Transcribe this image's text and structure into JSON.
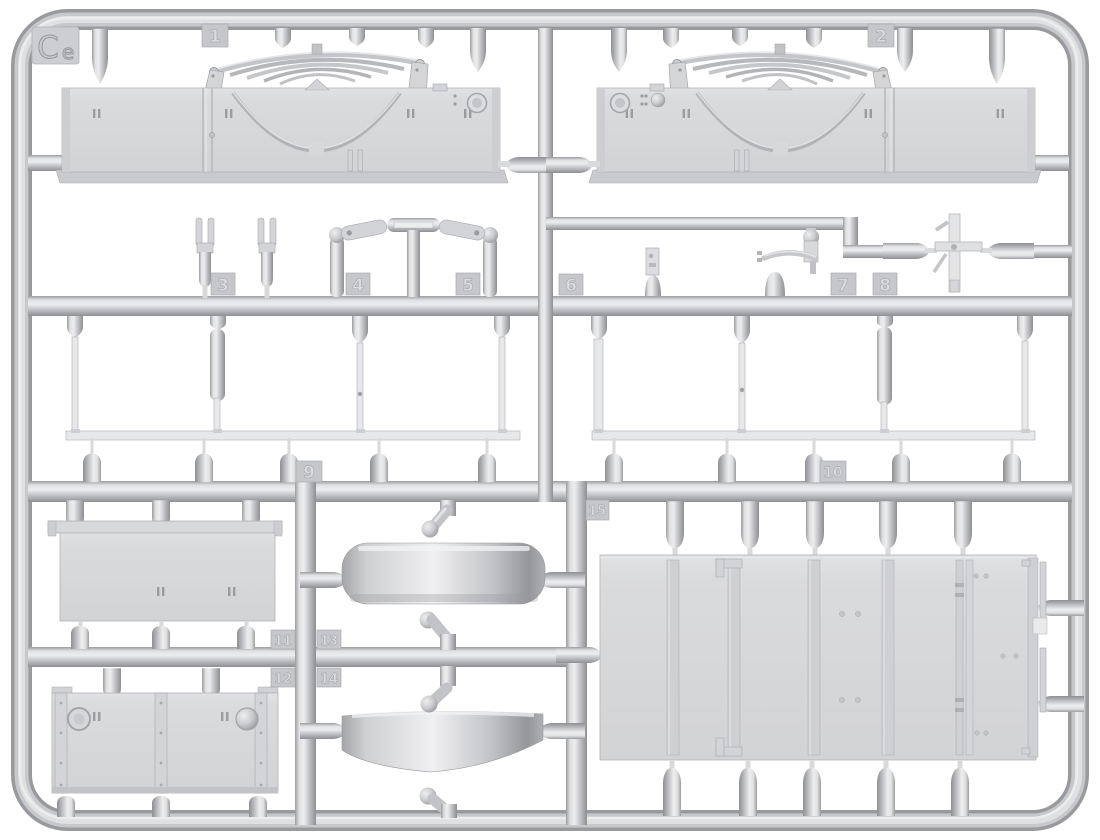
{
  "sprue": {
    "code": "Ce",
    "code_letter": "C",
    "code_suffix": "e",
    "material_color": "#c9cacd",
    "background_color": "#ffffff",
    "kind": "injection-molded model kit sprue with numbered parts"
  },
  "part_tags": [
    {
      "number": "1",
      "part": "long side panel with leaf spring, left"
    },
    {
      "number": "2",
      "part": "long side panel with leaf spring, right (mirrored)"
    },
    {
      "number": "3",
      "part": "pair of fork brackets"
    },
    {
      "number": "4",
      "part": "support post with link arm"
    },
    {
      "number": "5",
      "part": "support post with link arm"
    },
    {
      "number": "6",
      "part": "small bracket plate"
    },
    {
      "number": "7",
      "part": "control lever with curved arm"
    },
    {
      "number": "8",
      "part": "cross-shaped linkage"
    },
    {
      "number": "9",
      "part": "left group of thin rods with long rail"
    },
    {
      "number": "10",
      "part": "right group of thin rods with long rail"
    },
    {
      "number": "11",
      "part": "flat board with top lip"
    },
    {
      "number": "12",
      "part": "tailgate board with hinge strips and round bosses"
    },
    {
      "number": "13",
      "part": "wide cylindrical band, straight"
    },
    {
      "number": "14",
      "part": "wide cylindrical band, curved"
    },
    {
      "number": "15",
      "part": "large bed floor panel with ribs"
    }
  ]
}
